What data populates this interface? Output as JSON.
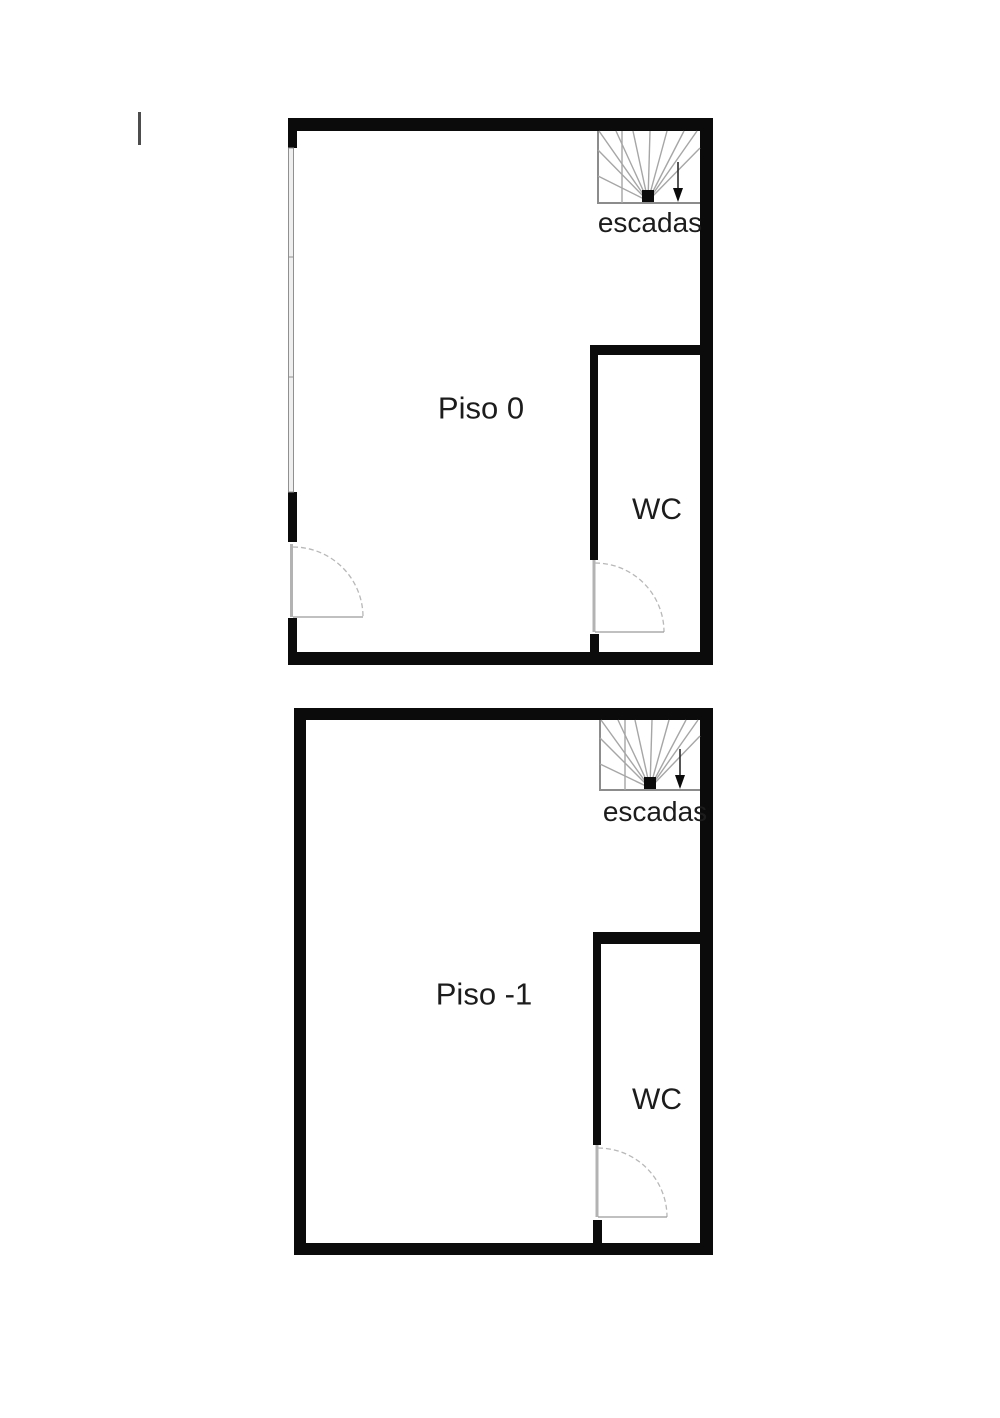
{
  "document": {
    "type": "floor-plan",
    "background": "#ffffff"
  },
  "colors": {
    "wall": "#0b0b0b",
    "stair_line": "#a6a6a6",
    "stair_box_edge": "#8c8c8c",
    "door_arc": "#b8b8b8",
    "door_line": "#b3b3b3",
    "window_fill": "#efefef",
    "window_edge": "#909090",
    "text": "#1c1c1c"
  },
  "floors": [
    {
      "id": "piso-0",
      "name": "Piso 0",
      "stairs_label": "escadas",
      "wc_label": "WC"
    },
    {
      "id": "piso-1",
      "name": "Piso -1",
      "stairs_label": "escadas",
      "wc_label": "WC"
    }
  ]
}
